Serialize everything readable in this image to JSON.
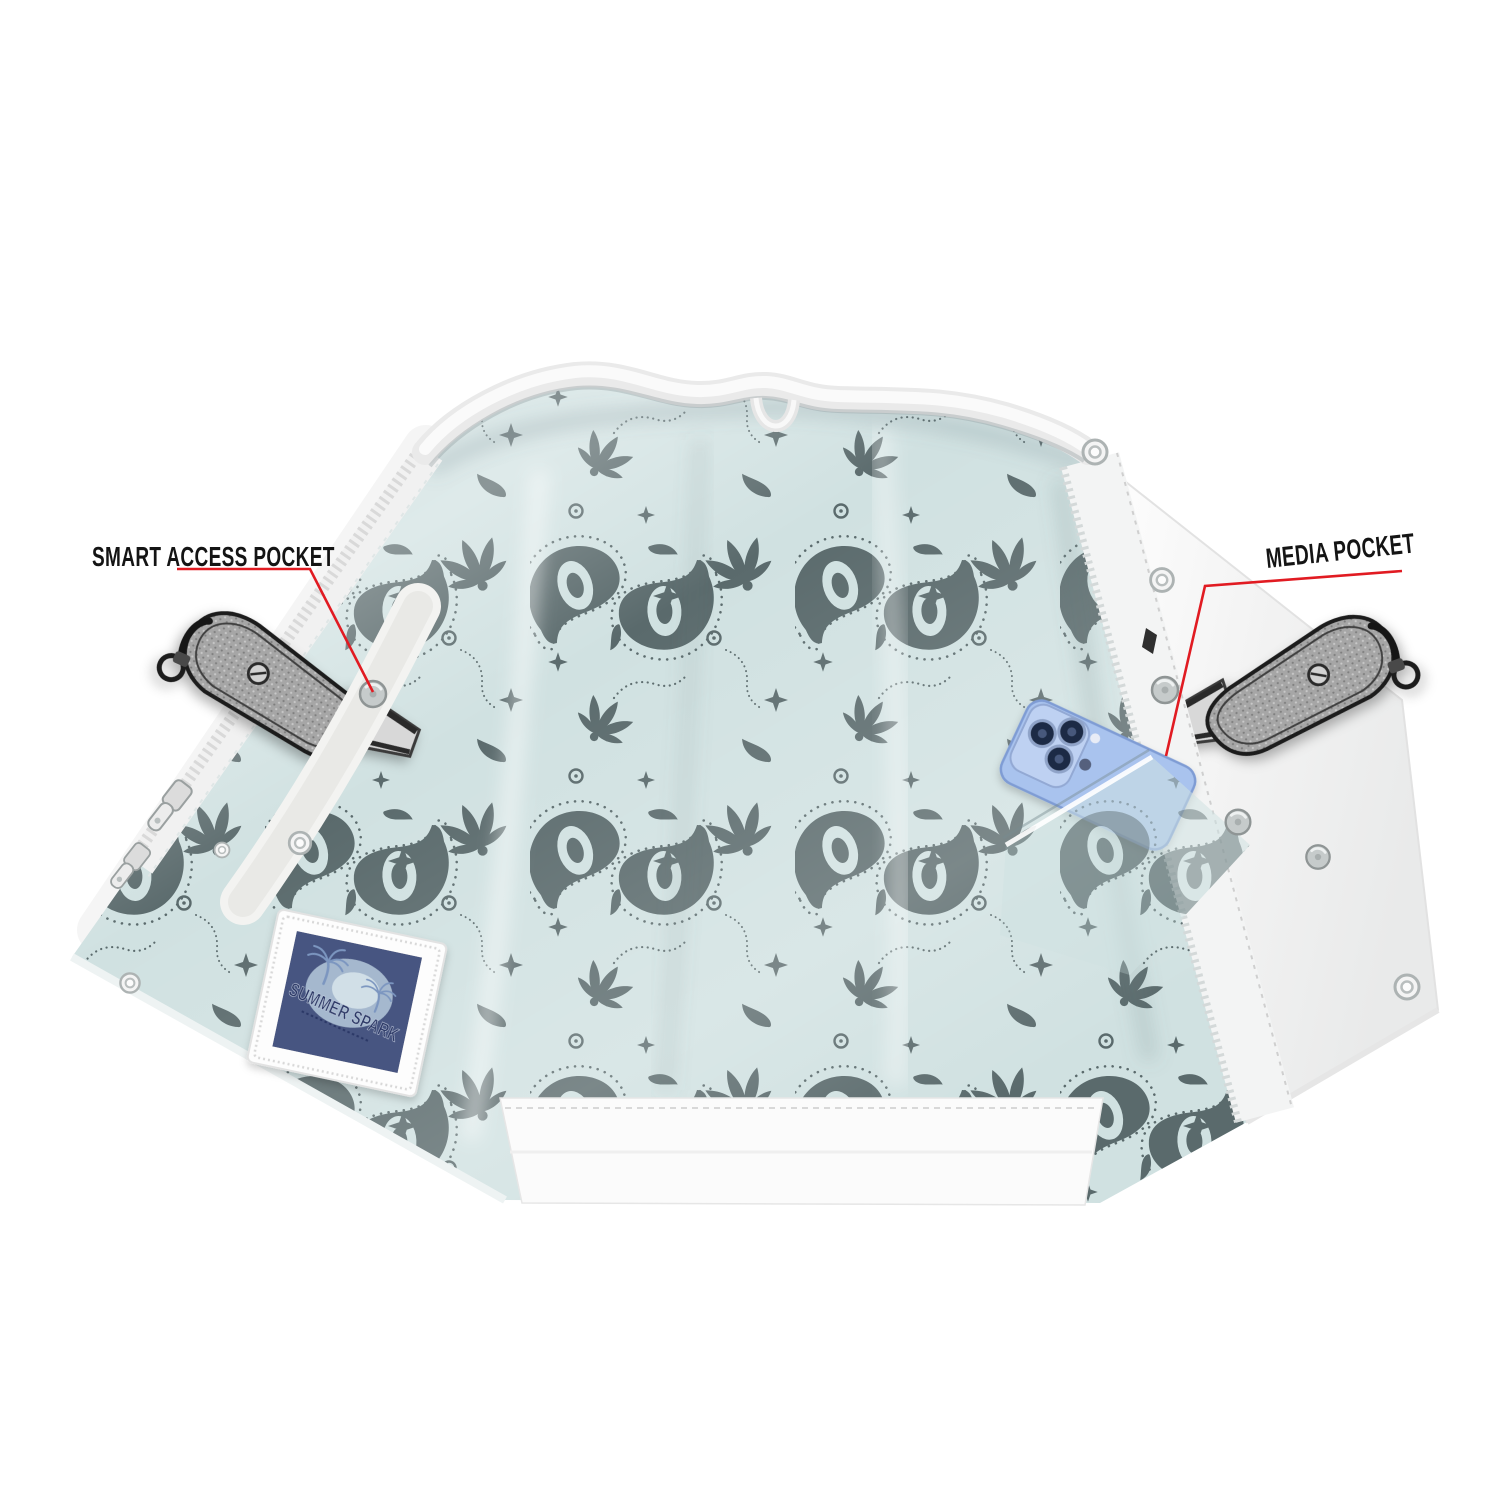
{
  "meta": {
    "description": "Open motorcycle vest interior with paisley bandana lining, concealed carry pockets holding pistols, a smartphone in a media pocket, and red feature callouts"
  },
  "callouts": {
    "smart_access_pocket": {
      "label": "SMART ACCESS POCKET"
    },
    "media_pocket": {
      "label": "MEDIA POCKET"
    }
  },
  "patch": {
    "title": "SUMMER SPARK"
  },
  "colors": {
    "background": "#ffffff",
    "accent_red": "#e11b22",
    "label_text": "#141414",
    "lining_base": "#d0e1e1",
    "paisley_motif": "#5a6a6c",
    "leather_white": "#f5f5f5",
    "phone_blue": "#a9c3ee",
    "patch_navy": "#475481",
    "gun_gray": "#a6a6a6"
  }
}
